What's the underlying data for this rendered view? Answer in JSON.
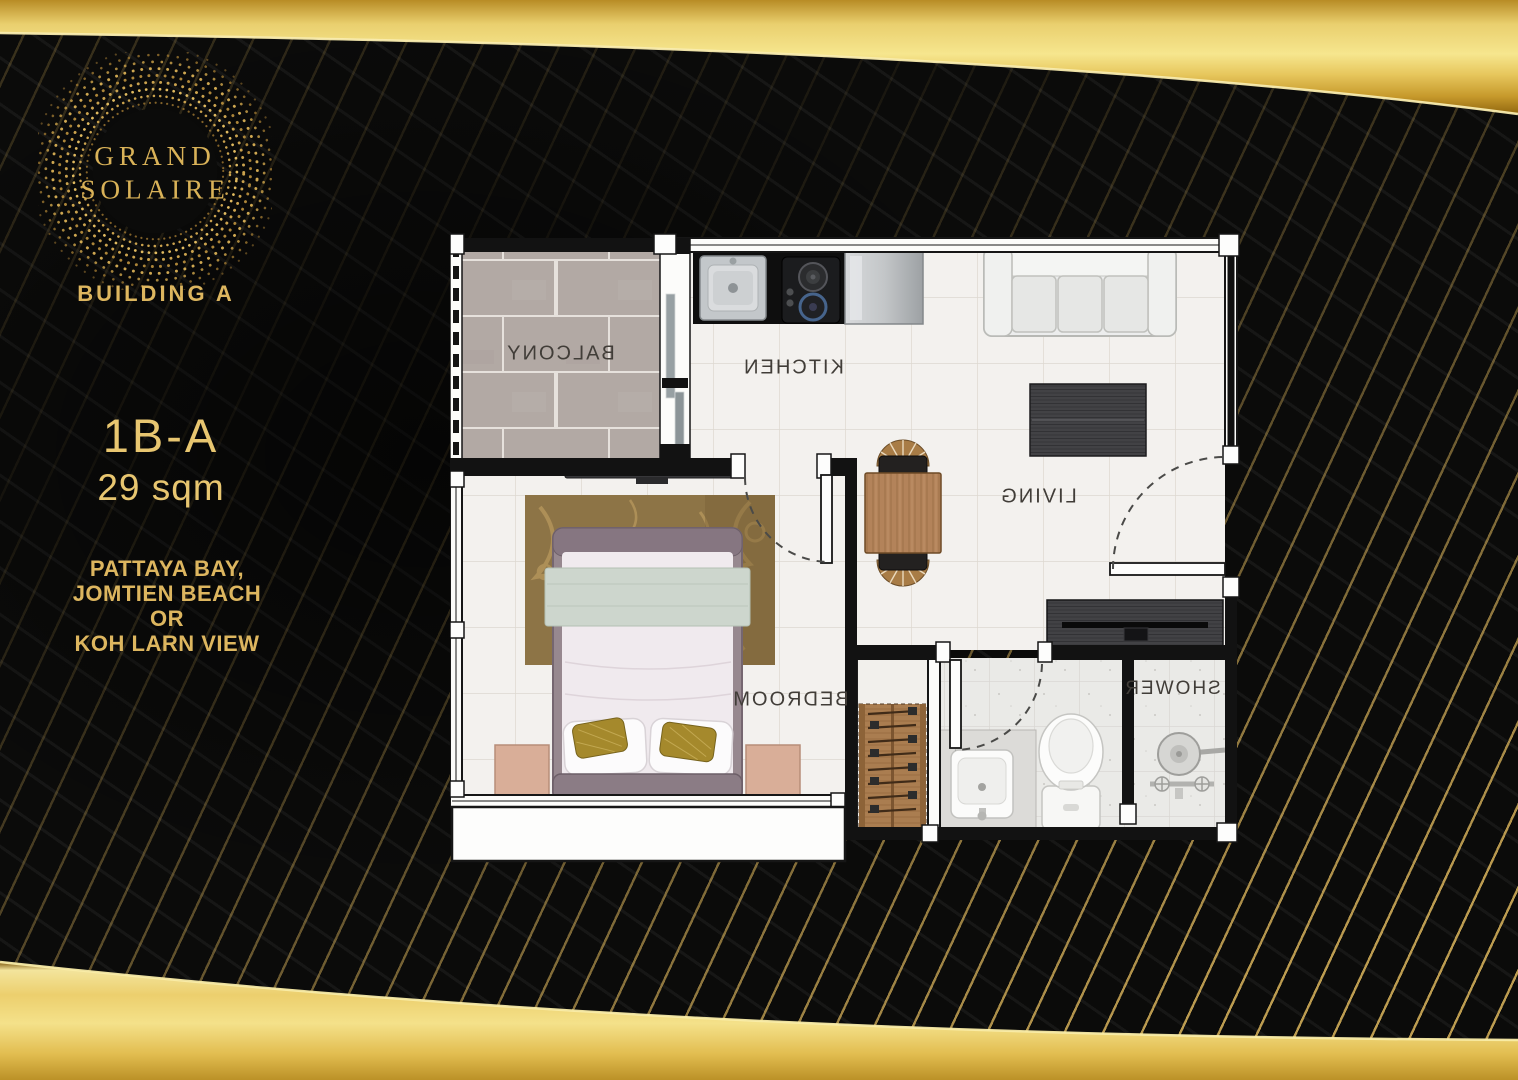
{
  "brand": {
    "name_line1": "GRAND",
    "name_line2": "SOLAIRE"
  },
  "building_label": "BUILDING A",
  "unit": {
    "type": "1B-A",
    "area": "29 sqm"
  },
  "view_lines": [
    "PATTAYA BAY,",
    "JOMTIEN BEACH",
    "OR",
    "KOH LARN VIEW"
  ],
  "floorplan": {
    "label_style": "mirrored",
    "rooms": [
      {
        "name": "balcony",
        "label": "BALCONY"
      },
      {
        "name": "kitchen",
        "label": "KITCHEN"
      },
      {
        "name": "living",
        "label": "LIVING"
      },
      {
        "name": "bedroom",
        "label": "BEDROOM"
      },
      {
        "name": "shower",
        "label": "SHOWER"
      }
    ]
  },
  "colors": {
    "gold": "#d9b257",
    "gold_bright": "#f4e38c",
    "background": "#0b0b0a",
    "floor_tile": "#f3f1ee",
    "balcony_tile": "#b2a9a4",
    "wall": "#141414",
    "plan_label": "#413d38"
  }
}
